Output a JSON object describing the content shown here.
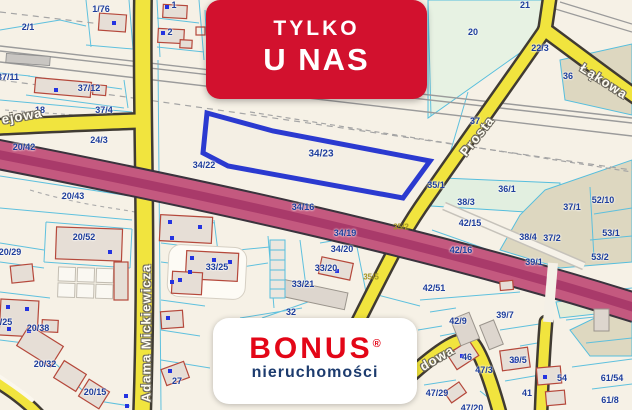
{
  "badge": {
    "line1": "TYLKO",
    "line2": "U NAS"
  },
  "logo": {
    "brand": "BONUS",
    "registered": "®",
    "subtitle": "nieruchomości"
  },
  "highlight": {
    "parcel": "34/23",
    "outline_color": "#2b3ad0"
  },
  "colors": {
    "badge_red": "#d2112e",
    "logo_red": "#e30617",
    "logo_navy": "#1c3b6e",
    "map_background": "#f6f1e6",
    "road_yellow": "#f1e43e",
    "artery_pink": "#c4597f",
    "artery_stripe": "#a93a6a",
    "parcel_line_cyan": "#56bedd",
    "parcel_label_navy": "#1e3e9c",
    "building_outline_red": "#b5483b",
    "highlight_blue": "#2b3ad0"
  },
  "map": {
    "street_labels": [
      {
        "t": "ejowa",
        "x": 22,
        "y": 116,
        "r": -10
      },
      {
        "t": "Adama Mickiewicza",
        "x": 146,
        "y": 333,
        "r": -90
      },
      {
        "t": "Prosta",
        "x": 477,
        "y": 136,
        "r": -52
      },
      {
        "t": "Łąkowa",
        "x": 604,
        "y": 81,
        "r": 33
      },
      {
        "t": "dowa",
        "x": 437,
        "y": 358,
        "r": -30
      }
    ],
    "parcel_labels": [
      {
        "t": "2/1",
        "x": 28,
        "y": 27
      },
      {
        "t": "1/76",
        "x": 101,
        "y": 9
      },
      {
        "t": "1",
        "x": 174,
        "y": 5
      },
      {
        "t": "2",
        "x": 170,
        "y": 32
      },
      {
        "t": "37/11",
        "x": 8,
        "y": 77
      },
      {
        "t": "37/12",
        "x": 89,
        "y": 88
      },
      {
        "t": "37/4",
        "x": 104,
        "y": 110
      },
      {
        "t": "18",
        "x": 40,
        "y": 110
      },
      {
        "t": "24/3",
        "x": 99,
        "y": 140
      },
      {
        "t": "20/42",
        "x": 24,
        "y": 147
      },
      {
        "t": "20/43",
        "x": 73,
        "y": 196
      },
      {
        "t": "20/52",
        "x": 84,
        "y": 237
      },
      {
        "t": "20/29",
        "x": 10,
        "y": 252
      },
      {
        "t": "/25",
        "x": 6,
        "y": 322
      },
      {
        "t": "20/38",
        "x": 38,
        "y": 328
      },
      {
        "t": "20/32",
        "x": 45,
        "y": 364
      },
      {
        "t": "20/15",
        "x": 95,
        "y": 392
      },
      {
        "t": "33/25",
        "x": 217,
        "y": 267
      },
      {
        "t": "33/21",
        "x": 303,
        "y": 284
      },
      {
        "t": "33/20",
        "x": 326,
        "y": 268
      },
      {
        "t": "34/20",
        "x": 342,
        "y": 249
      },
      {
        "t": "34/19",
        "x": 345,
        "y": 233
      },
      {
        "t": "34/16",
        "x": 303,
        "y": 207
      },
      {
        "t": "34/22",
        "x": 204,
        "y": 165
      },
      {
        "t": "34/23",
        "x": 321,
        "y": 154,
        "big": true
      },
      {
        "t": "32",
        "x": 291,
        "y": 312
      },
      {
        "t": "27",
        "x": 177,
        "y": 381
      },
      {
        "t": "35/1",
        "x": 436,
        "y": 185
      },
      {
        "t": "37",
        "x": 475,
        "y": 121
      },
      {
        "t": "38/3",
        "x": 466,
        "y": 202
      },
      {
        "t": "42/15",
        "x": 470,
        "y": 223
      },
      {
        "t": "42/16",
        "x": 461,
        "y": 250
      },
      {
        "t": "39/1",
        "x": 534,
        "y": 262
      },
      {
        "t": "36/1",
        "x": 507,
        "y": 189
      },
      {
        "t": "38/4",
        "x": 528,
        "y": 237
      },
      {
        "t": "37/1",
        "x": 572,
        "y": 207
      },
      {
        "t": "37/2",
        "x": 552,
        "y": 238
      },
      {
        "t": "52/10",
        "x": 603,
        "y": 200
      },
      {
        "t": "53/1",
        "x": 611,
        "y": 233
      },
      {
        "t": "53/2",
        "x": 600,
        "y": 257
      },
      {
        "t": "21",
        "x": 525,
        "y": 5
      },
      {
        "t": "20",
        "x": 473,
        "y": 32
      },
      {
        "t": "22/3",
        "x": 540,
        "y": 48
      },
      {
        "t": "36",
        "x": 568,
        "y": 76
      },
      {
        "t": "42/51",
        "x": 434,
        "y": 288
      },
      {
        "t": "42/9",
        "x": 458,
        "y": 321
      },
      {
        "t": "39/7",
        "x": 505,
        "y": 315
      },
      {
        "t": "46",
        "x": 467,
        "y": 357
      },
      {
        "t": "47/3",
        "x": 484,
        "y": 370
      },
      {
        "t": "47/29",
        "x": 437,
        "y": 393
      },
      {
        "t": "39/5",
        "x": 518,
        "y": 360
      },
      {
        "t": "54",
        "x": 562,
        "y": 378
      },
      {
        "t": "41",
        "x": 527,
        "y": 393
      },
      {
        "t": "61/54",
        "x": 612,
        "y": 378
      },
      {
        "t": "61/8",
        "x": 610,
        "y": 400
      },
      {
        "t": "47/20",
        "x": 472,
        "y": 408
      }
    ],
    "road_labels": [
      {
        "t": "35/2",
        "x": 401,
        "y": 227
      },
      {
        "t": "35/5",
        "x": 371,
        "y": 277
      }
    ]
  }
}
